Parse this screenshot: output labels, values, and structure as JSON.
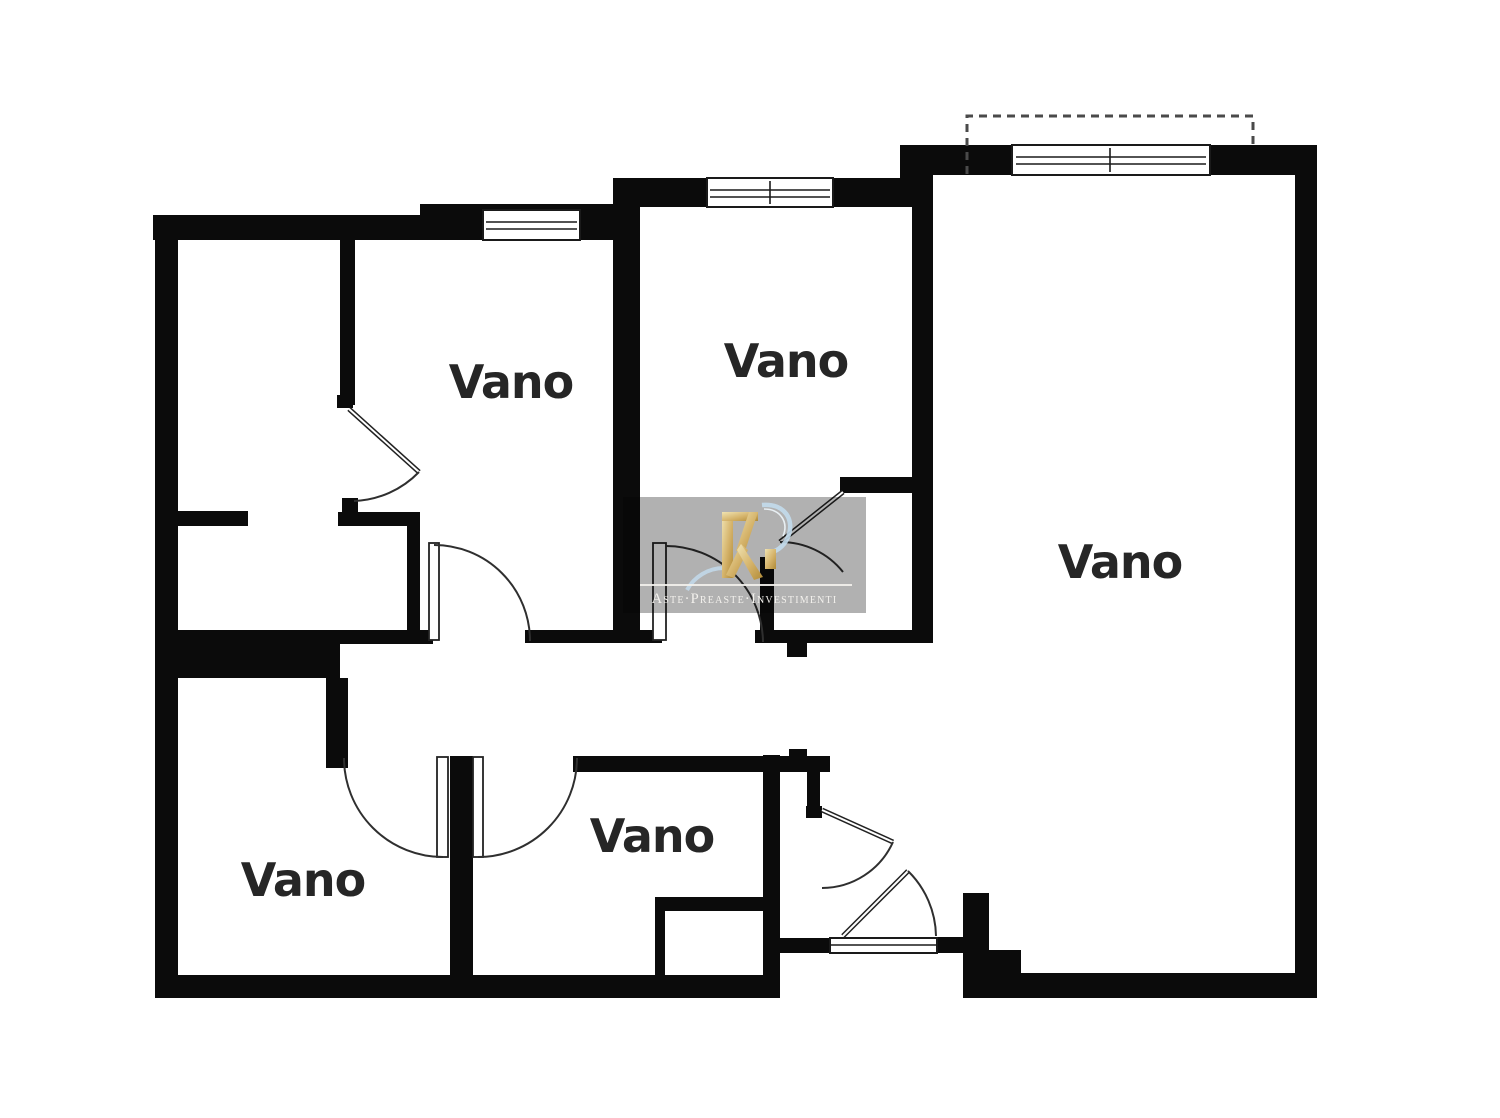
{
  "plan": {
    "type": "apartment-floor-plan",
    "rooms": [
      {
        "id": "room-top-left",
        "label": "Vano",
        "position": "upper-left"
      },
      {
        "id": "room-top-middle",
        "label": "Vano",
        "position": "upper-middle"
      },
      {
        "id": "room-right",
        "label": "Vano",
        "position": "right"
      },
      {
        "id": "room-bottom-left",
        "label": "Vano",
        "position": "lower-left"
      },
      {
        "id": "room-bottom-middle",
        "label": "Vano",
        "position": "lower-middle"
      }
    ],
    "features": {
      "windows": 3,
      "balcony_outline": "dashed rectangle top-right",
      "entrance": "double swing door bottom-middle"
    },
    "colors": {
      "wall": "#0b0b0b",
      "background": "#ffffff",
      "door_line": "#2f2f2f",
      "balcony_dash": "#4a4a4a",
      "label_text": "#262626"
    }
  },
  "watermark": {
    "brand_text": "Aste·Preaste·Investimenti",
    "logo": "RI-monogram",
    "colors": {
      "box_gray": "#b1b1b1",
      "logo_gold": "#c9a24d",
      "swoosh_blue": "#c3dbec",
      "text": "#f3f1ed"
    }
  }
}
